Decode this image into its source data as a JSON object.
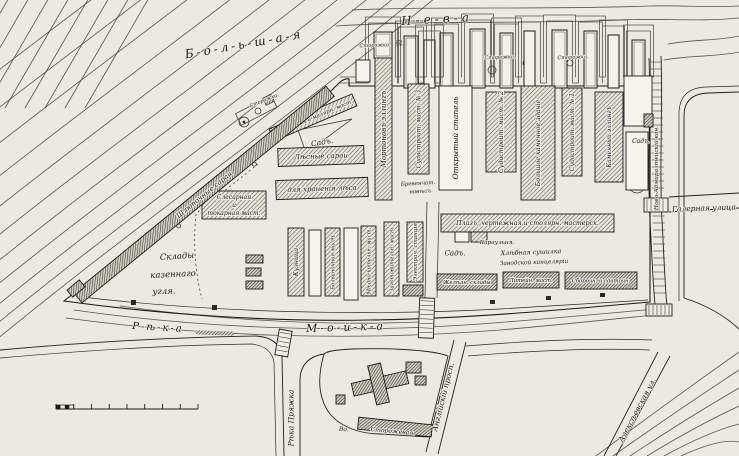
{
  "colors": {
    "paper": "#ebe9e2",
    "island": "#f4f3ee",
    "ink": "#1b1b18",
    "hatch_light": "#55534c",
    "hatch_dark": "#34322c"
  },
  "map": {
    "region_labels": [
      {
        "id": "bolshaya-neva",
        "text": "Б-о-л-ь-ш-а-я",
        "x": 244,
        "y": 44,
        "rot": -10,
        "size": 12,
        "sp": 3
      },
      {
        "id": "neva",
        "text": "Н-е-в-а",
        "x": 437,
        "y": 19,
        "rot": -3,
        "size": 12,
        "sp": 4
      },
      {
        "id": "reka",
        "text": "Р-ѣ-к-а",
        "x": 158,
        "y": 327,
        "rot": 3,
        "size": 10,
        "sp": 2
      },
      {
        "id": "moika",
        "text": "М-о-й-к-а",
        "x": 346,
        "y": 327,
        "rot": -2,
        "size": 11,
        "sp": 3
      },
      {
        "id": "galernaya-ulitsa",
        "text": "Галерная улица",
        "x": 704,
        "y": 208,
        "rot": -2,
        "size": 7.5
      },
      {
        "id": "reka-pryazhka",
        "text": "Рѣка Пряжка",
        "x": 291,
        "y": 418,
        "rot": -90,
        "size": 7.5
      },
      {
        "id": "anglysky-prospekt",
        "text": "Англійскій просп.",
        "x": 443,
        "y": 397,
        "rot": -76,
        "size": 7.5
      },
      {
        "id": "alekseevskaya-ulitsa",
        "text": "Алексѣевская ул.",
        "x": 637,
        "y": 410,
        "rot": -62,
        "size": 7.5
      },
      {
        "id": "novo-admiralteysky-canal",
        "text": "Ново-Адмиралтейскій кан.",
        "x": 656,
        "y": 168,
        "rot": -90,
        "size": 5.8
      },
      {
        "id": "sklady-1",
        "text": "Склады",
        "x": 177,
        "y": 256,
        "rot": -4,
        "size": 8.5
      },
      {
        "id": "sklady-2",
        "text": "казеннаго",
        "x": 173,
        "y": 274,
        "rot": -3,
        "size": 8.5
      },
      {
        "id": "sklady-3",
        "text": "угля.",
        "x": 164,
        "y": 291,
        "rot": -2,
        "size": 8.5
      },
      {
        "id": "sad-1",
        "text": "Садъ.",
        "x": 322,
        "y": 142,
        "rot": -10,
        "size": 7.5
      },
      {
        "id": "sad-2",
        "text": "Садъ.",
        "x": 641,
        "y": 141,
        "rot": 0,
        "size": 6
      },
      {
        "id": "sad-3",
        "text": "Садъ.",
        "x": 455,
        "y": 253,
        "rot": 0,
        "size": 7
      },
      {
        "id": "yard-label-1",
        "text": "Хлѣбная сушилка",
        "x": 531,
        "y": 252,
        "rot": -2,
        "size": 6.3
      },
      {
        "id": "yard-label-2",
        "text": "Заводской канцеляріи",
        "x": 534,
        "y": 262,
        "rot": -2,
        "size": 5.8
      },
      {
        "id": "karaulnya",
        "text": "Караульня.",
        "x": 497,
        "y": 242,
        "rot": 0,
        "size": 5.8
      },
      {
        "id": "naves-1",
        "text": "Бревенчат.",
        "x": 418,
        "y": 183,
        "rot": -3,
        "size": 5.5
      },
      {
        "id": "naves-2",
        "text": "навѣсъ.",
        "x": 421,
        "y": 191,
        "rot": -3,
        "size": 5.5
      },
      {
        "id": "storozhka-1",
        "text": "Сторожка.",
        "x": 375,
        "y": 45,
        "rot": -2,
        "size": 5
      },
      {
        "id": "storozhka-2",
        "text": "Сторожка.",
        "x": 500,
        "y": 57,
        "rot": -2,
        "size": 5
      },
      {
        "id": "storozhka-3",
        "text": "Сторожка.",
        "x": 573,
        "y": 57,
        "rot": -2,
        "size": 5
      },
      {
        "id": "storozhka-4",
        "text": "Сторожка.",
        "x": 264,
        "y": 100,
        "rot": -22,
        "size": 5
      },
      {
        "id": "south-street-1",
        "text": "Во.",
        "x": 344,
        "y": 429,
        "rot": 4,
        "size": 6
      },
      {
        "id": "south-street-2",
        "text": "Сторожевая.",
        "x": 393,
        "y": 431,
        "rot": 5,
        "size": 6
      }
    ],
    "buildings": [
      {
        "id": "morton-elling",
        "label": "Мортоновъ эллингъ",
        "x": 375,
        "y": 58,
        "w": 17,
        "h": 142,
        "fill": "hatch",
        "lrot": -90,
        "size": 7
      },
      {
        "id": "sudostroit-mast-3",
        "label": "Судостроит. маст. № 3",
        "x": 408,
        "y": 84,
        "w": 21,
        "h": 90,
        "fill": "hatch",
        "lrot": -90,
        "size": 6
      },
      {
        "id": "otkryty-stapel",
        "label": "Открытый стапель",
        "x": 439,
        "y": 86,
        "w": 33,
        "h": 104,
        "fill": "none",
        "lrot": -90,
        "size": 7.5
      },
      {
        "id": "sudostroit-mast-2",
        "label": "Судостроит. маст. № 2",
        "x": 486,
        "y": 92,
        "w": 30,
        "h": 80,
        "fill": "hatch",
        "lrot": -90,
        "size": 6.3
      },
      {
        "id": "bolshoe-kamennoe-zdanie",
        "label": "Большое каменное зданіе",
        "x": 521,
        "y": 86,
        "w": 34,
        "h": 114,
        "fill": "hatch",
        "lrot": -90,
        "size": 6.3
      },
      {
        "id": "sudostroit-mast-1",
        "label": "Судостроит. маст. № 1",
        "x": 562,
        "y": 88,
        "w": 20,
        "h": 88,
        "fill": "hatch",
        "lrot": -90,
        "size": 6
      },
      {
        "id": "kamenny-elling",
        "label": "Каменный эллингъ",
        "x": 595,
        "y": 92,
        "w": 28,
        "h": 90,
        "fill": "hatch",
        "lrot": -90,
        "size": 6
      },
      {
        "id": "lesnye-sarai",
        "label": "Лѣсные сараи",
        "x": 278,
        "y": 147,
        "w": 86,
        "h": 18,
        "fill": "hatch",
        "rot": -2,
        "size": 7
      },
      {
        "id": "dlya-khraneniya-lesa",
        "label": "для храненія лѣса",
        "x": 276,
        "y": 179,
        "w": 92,
        "h": 19,
        "fill": "hatch",
        "rot": -2,
        "size": 7
      },
      {
        "id": "okrasochnaya-mast",
        "label": "Окрасочная и малярн. маст.",
        "x": 268,
        "y": 111,
        "w": 90,
        "h": 13,
        "fill": "hatch",
        "rot": -23,
        "size": 5.5
      },
      {
        "id": "slesarnaya-tokarnaya-mast",
        "label": [
          "Слесарная",
          "и",
          "токарная маст."
        ],
        "x": 202,
        "y": 191,
        "w": 64,
        "h": 28,
        "fill": "hatch",
        "size": 6
      },
      {
        "id": "shlyupochnye-sarai",
        "label": "Шлюпочные сараи",
        "x": 41,
        "y": 188,
        "w": 326,
        "h": 13,
        "fill": "dense",
        "rot": -39.3,
        "size": 7
      },
      {
        "id": "kuznitsa",
        "label": "Кузница",
        "x": 288,
        "y": 228,
        "w": 16,
        "h": 68,
        "fill": "hatch",
        "lrot": -90,
        "size": 6.3
      },
      {
        "id": "shed-a",
        "label": "",
        "x": 309,
        "y": 230,
        "w": 12,
        "h": 66,
        "fill": "none"
      },
      {
        "id": "bolvanochnaya-mast",
        "label": "Болваночная маст.",
        "x": 325,
        "y": 228,
        "w": 15,
        "h": 68,
        "fill": "hatch",
        "lrot": -90,
        "size": 5.3
      },
      {
        "id": "shed-b",
        "label": "",
        "x": 344,
        "y": 228,
        "w": 14,
        "h": 72,
        "fill": "none"
      },
      {
        "id": "medno-kotelnaya-mast",
        "label": "Мѣдно-котельн. маст.",
        "x": 361,
        "y": 226,
        "w": 15,
        "h": 70,
        "fill": "hatch",
        "lrot": -90,
        "size": 5.3
      },
      {
        "id": "zagotovit-mast",
        "label": "Заготовительн. маст.",
        "x": 384,
        "y": 222,
        "w": 15,
        "h": 74,
        "fill": "hatch",
        "lrot": -90,
        "size": 5.3
      },
      {
        "id": "elektro-stantsiya",
        "label": "Электрич. станція",
        "x": 407,
        "y": 222,
        "w": 16,
        "h": 60,
        "fill": "hatch",
        "lrot": -90,
        "size": 5.5
      },
      {
        "id": "small-box",
        "label": "",
        "x": 403,
        "y": 285,
        "w": 20,
        "h": 11,
        "fill": "dense"
      },
      {
        "id": "plaz-chertezhnaya",
        "label": "Плазъ, чертежная и столярн. мастерск.",
        "x": 441,
        "y": 214,
        "w": 173,
        "h": 18,
        "fill": "hatch",
        "size": 6.3
      },
      {
        "id": "zhelezn-sklady",
        "label": "Желѣзн. склады",
        "x": 437,
        "y": 274,
        "w": 60,
        "h": 16,
        "fill": "dense",
        "size": 5.3
      },
      {
        "id": "liteynaya-mast",
        "label": "Литейн. маст.",
        "x": 503,
        "y": 272,
        "w": 56,
        "h": 16,
        "fill": "dense",
        "size": 5.3
      },
      {
        "id": "sborochnaya-sdatochnaya",
        "label": "Сборочн. и сдаточн.",
        "x": 565,
        "y": 272,
        "w": 72,
        "h": 17,
        "fill": "dense",
        "size": 5.3
      },
      {
        "id": "shed-c",
        "label": "",
        "x": 455,
        "y": 232,
        "w": 14,
        "h": 10,
        "fill": "none"
      },
      {
        "id": "shed-d",
        "label": "",
        "x": 471,
        "y": 232,
        "w": 16,
        "h": 10,
        "fill": "hatch"
      },
      {
        "id": "east-white-1",
        "label": "",
        "x": 624,
        "y": 76,
        "w": 28,
        "h": 50,
        "fill": "none"
      },
      {
        "id": "east-white-2",
        "label": "",
        "x": 626,
        "y": 132,
        "w": 22,
        "h": 58,
        "fill": "none"
      },
      {
        "id": "east-dark",
        "label": "",
        "x": 644,
        "y": 114,
        "w": 9,
        "h": 13,
        "fill": "dense"
      },
      {
        "id": "west-tip-shed",
        "label": "",
        "x": 68,
        "y": 284,
        "w": 16,
        "h": 9,
        "fill": "dense",
        "rot": -40
      },
      {
        "id": "coal-shed-1",
        "label": "",
        "x": 246,
        "y": 255,
        "w": 17,
        "h": 8,
        "fill": "dense"
      },
      {
        "id": "coal-shed-2",
        "label": "",
        "x": 246,
        "y": 268,
        "w": 15,
        "h": 8,
        "fill": "dense"
      },
      {
        "id": "coal-shed-3",
        "label": "",
        "x": 246,
        "y": 281,
        "w": 17,
        "h": 8,
        "fill": "dense"
      },
      {
        "id": "church-main",
        "label": "",
        "x": 352,
        "y": 377,
        "w": 56,
        "h": 13,
        "fill": "dense",
        "rot": -13
      },
      {
        "id": "church-wing",
        "label": "",
        "x": 372,
        "y": 364,
        "w": 13,
        "h": 40,
        "fill": "dense",
        "rot": -13
      },
      {
        "id": "church-sq-1",
        "label": "",
        "x": 406,
        "y": 362,
        "w": 15,
        "h": 11,
        "fill": "dense"
      },
      {
        "id": "church-sq-2",
        "label": "",
        "x": 415,
        "y": 376,
        "w": 11,
        "h": 9,
        "fill": "dense"
      },
      {
        "id": "south-strip",
        "label": "",
        "x": 358,
        "y": 421,
        "w": 74,
        "h": 12,
        "fill": "dense",
        "rot": 6
      },
      {
        "id": "south-sq",
        "label": "",
        "x": 336,
        "y": 395,
        "w": 9,
        "h": 9,
        "fill": "dense"
      },
      {
        "id": "quay-shed",
        "label": "",
        "x": 356,
        "y": 60,
        "w": 14,
        "h": 22,
        "fill": "none"
      }
    ],
    "scale_bar": {
      "x": 56,
      "y": 409,
      "length": 142,
      "segments": 8
    }
  }
}
